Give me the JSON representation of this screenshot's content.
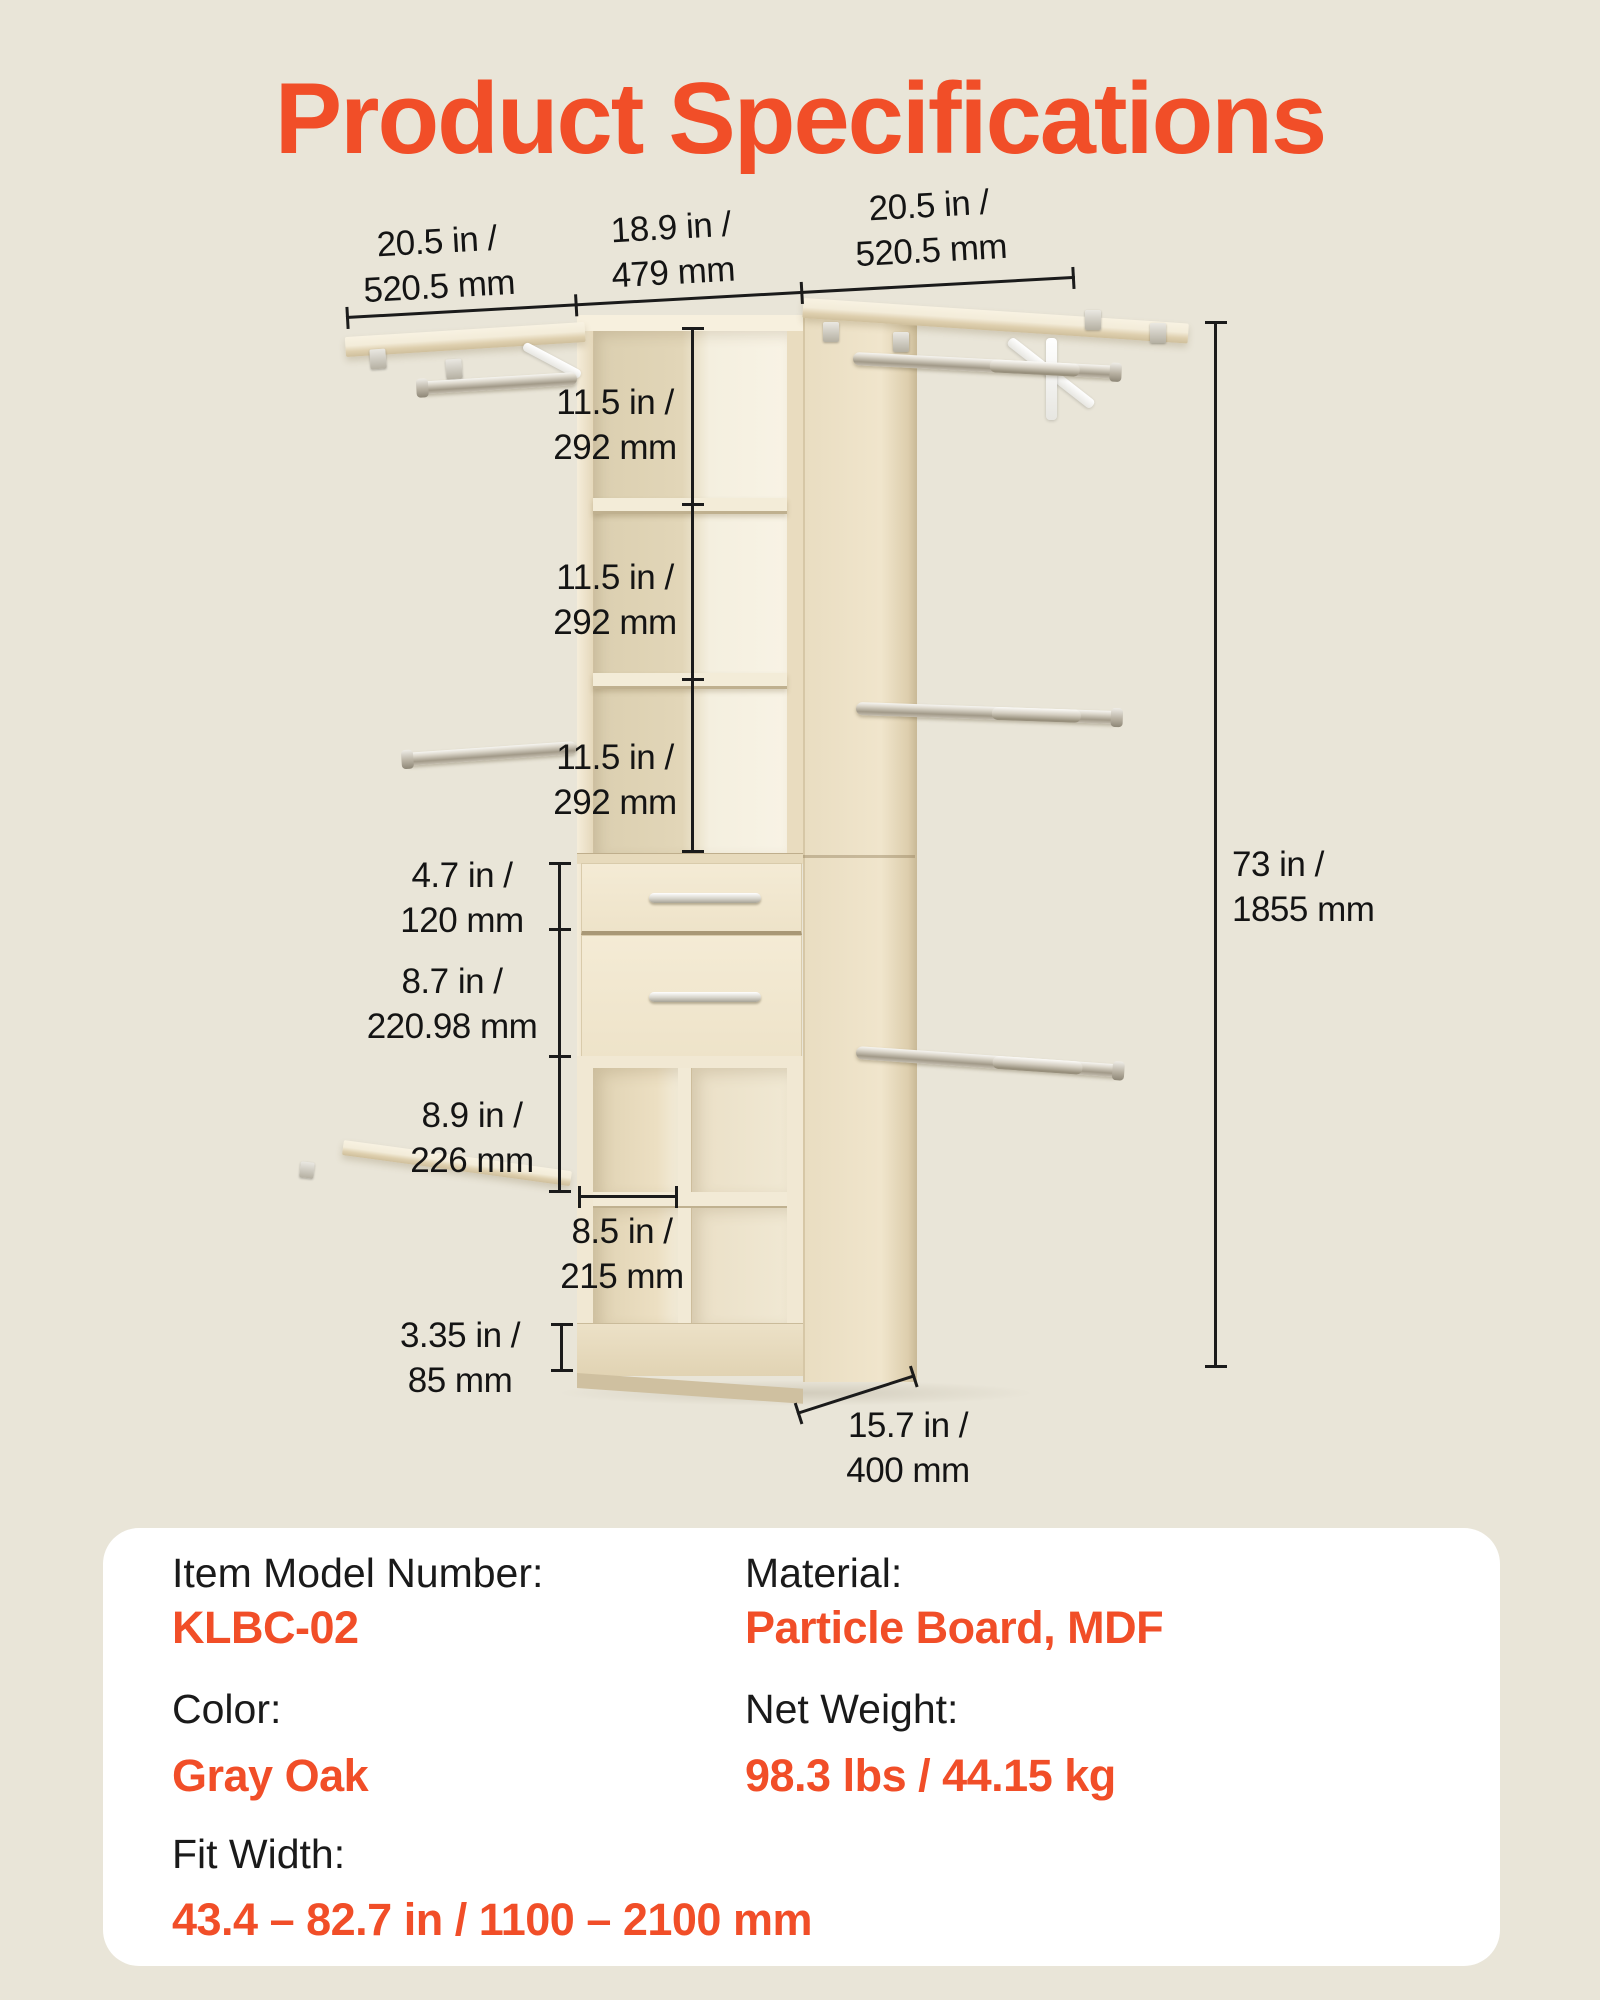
{
  "page": {
    "title": "Product Specifications",
    "background_color": "#e9e5d8",
    "accent_color": "#f14e28"
  },
  "dimensions": [
    {
      "id": "left-shelf-width",
      "line1": "20.5 in /",
      "line2": "520.5 mm"
    },
    {
      "id": "center-tower-width",
      "line1": "18.9 in /",
      "line2": "479 mm"
    },
    {
      "id": "right-shelf-width",
      "line1": "20.5 in /",
      "line2": "520.5 mm"
    },
    {
      "id": "upper-shelf-1-height",
      "line1": "11.5 in /",
      "line2": "292 mm"
    },
    {
      "id": "upper-shelf-2-height",
      "line1": "11.5 in /",
      "line2": "292 mm"
    },
    {
      "id": "upper-shelf-3-height",
      "line1": "11.5 in /",
      "line2": "292 mm"
    },
    {
      "id": "drawer-1-height",
      "line1": "4.7 in /",
      "line2": "120 mm"
    },
    {
      "id": "drawer-2-height",
      "line1": "8.7 in /",
      "line2": "220.98 mm"
    },
    {
      "id": "side-shelf-clearance",
      "line1": "8.9 in /",
      "line2": "226 mm"
    },
    {
      "id": "cubby-width",
      "line1": "8.5 in /",
      "line2": "215 mm"
    },
    {
      "id": "base-height",
      "line1": "3.35 in /",
      "line2": "85 mm"
    },
    {
      "id": "depth",
      "line1": "15.7 in /",
      "line2": "400 mm"
    },
    {
      "id": "total-height",
      "line1": "73 in /",
      "line2": "1855 mm"
    }
  ],
  "specs": {
    "left": [
      {
        "label": "Item Model Number:",
        "value": "KLBC-02"
      },
      {
        "label": "Color:",
        "value": "Gray Oak"
      },
      {
        "label": "Fit Width:",
        "value": "43.4 – 82.7 in / 1100 – 2100 mm"
      }
    ],
    "right": [
      {
        "label": "Material:",
        "value": "Particle Board, MDF"
      },
      {
        "label": "Net Weight:",
        "value": "98.3 lbs / 44.15 kg"
      }
    ]
  }
}
